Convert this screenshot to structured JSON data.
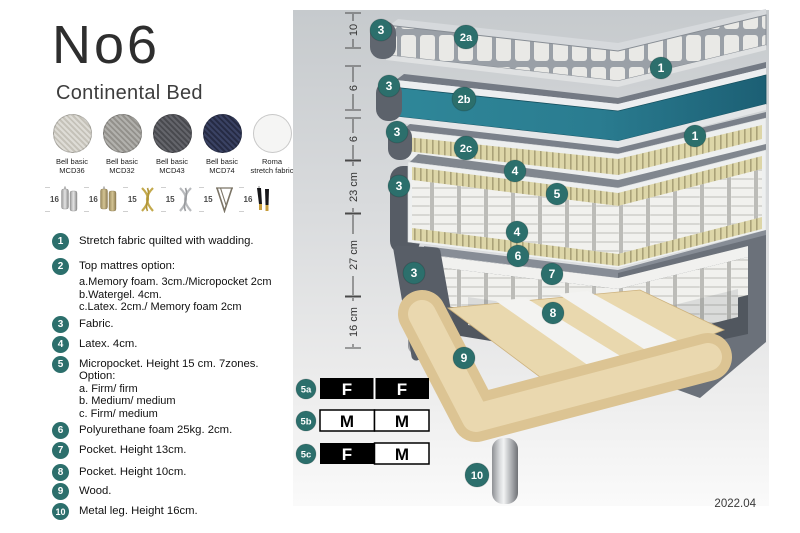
{
  "title": "No6",
  "subtitle": "Continental Bed",
  "version": "2022.04",
  "colors": {
    "badge_teal": "#2c6f6c",
    "watergel_teal": "#2b7e92",
    "latex_tan": "#ddd6a8",
    "wood": "#e3cd9d",
    "fabric_gray": "#6b717a"
  },
  "swatches": [
    {
      "name": "Bell basic",
      "code": "MCD36"
    },
    {
      "name": "Bell basic",
      "code": "MCD32"
    },
    {
      "name": "Bell basic",
      "code": "MCD43"
    },
    {
      "name": "Bell basic",
      "code": "MCD74"
    },
    {
      "name": "Roma",
      "code": "stretch fabric"
    }
  ],
  "legs": [
    {
      "height": "16",
      "type": "cylinder-silver"
    },
    {
      "height": "16",
      "type": "cylinder-brass"
    },
    {
      "height": "15",
      "type": "twisted-gold"
    },
    {
      "height": "15",
      "type": "twisted-silver"
    },
    {
      "height": "15",
      "type": "hairpin"
    },
    {
      "height": "16",
      "type": "tapered-black-gold"
    }
  ],
  "features": [
    {
      "num": "1",
      "text": "Stretch fabric quilted with wadding."
    },
    {
      "num": "2",
      "text": "Top mattres option:",
      "sub": [
        "a.Memory foam. 3cm./Micropocket 2cm",
        "b.Watergel. 4cm.",
        "c.Latex. 2cm./ Memory foam 2cm"
      ]
    },
    {
      "num": "3",
      "text": "Fabric."
    },
    {
      "num": "4",
      "text": "Latex. 4cm."
    },
    {
      "num": "5",
      "text": "Micropocket. Height 15 cm. 7zones. Option:",
      "sub": [
        "a. Firm/ firm",
        "b. Medium/ medium",
        "c. Firm/ medium"
      ]
    },
    {
      "num": "6",
      "text": "Polyurethane foam 25kg. 2cm."
    },
    {
      "num": "7",
      "text": "Pocket. Height 13cm."
    },
    {
      "num": "8",
      "text": "Pocket. Height 10cm."
    },
    {
      "num": "9",
      "text": "Wood."
    },
    {
      "num": "10",
      "text": "Metal leg. Height 16cm."
    }
  ],
  "measurements": {
    "m1": "10",
    "m2": "6",
    "m3": "6",
    "m4": "23 cm",
    "m5": "27 cm",
    "m6": "16 cm"
  },
  "diagram_badges": {
    "top3": "3",
    "l2a": "2a",
    "r1a": "1",
    "mid3": "3",
    "l2b": "2b",
    "low3": "3",
    "l2c": "2c",
    "r1b": "1",
    "lat4a": "4",
    "spring5": "5",
    "lat4b": "4",
    "mat3": "3",
    "box3": "3",
    "foam6": "6",
    "pocket7": "7",
    "pocket8": "8",
    "wood9": "9",
    "leg10": "10"
  },
  "firmness": [
    {
      "label": "5a",
      "cells": [
        {
          "letter": "F",
          "variant": "dark"
        },
        {
          "letter": "F",
          "variant": "dark"
        }
      ]
    },
    {
      "label": "5b",
      "cells": [
        {
          "letter": "M",
          "variant": "light"
        },
        {
          "letter": "M",
          "variant": "light"
        }
      ]
    },
    {
      "label": "5c",
      "cells": [
        {
          "letter": "F",
          "variant": "dark"
        },
        {
          "letter": "M",
          "variant": "light"
        }
      ]
    }
  ]
}
